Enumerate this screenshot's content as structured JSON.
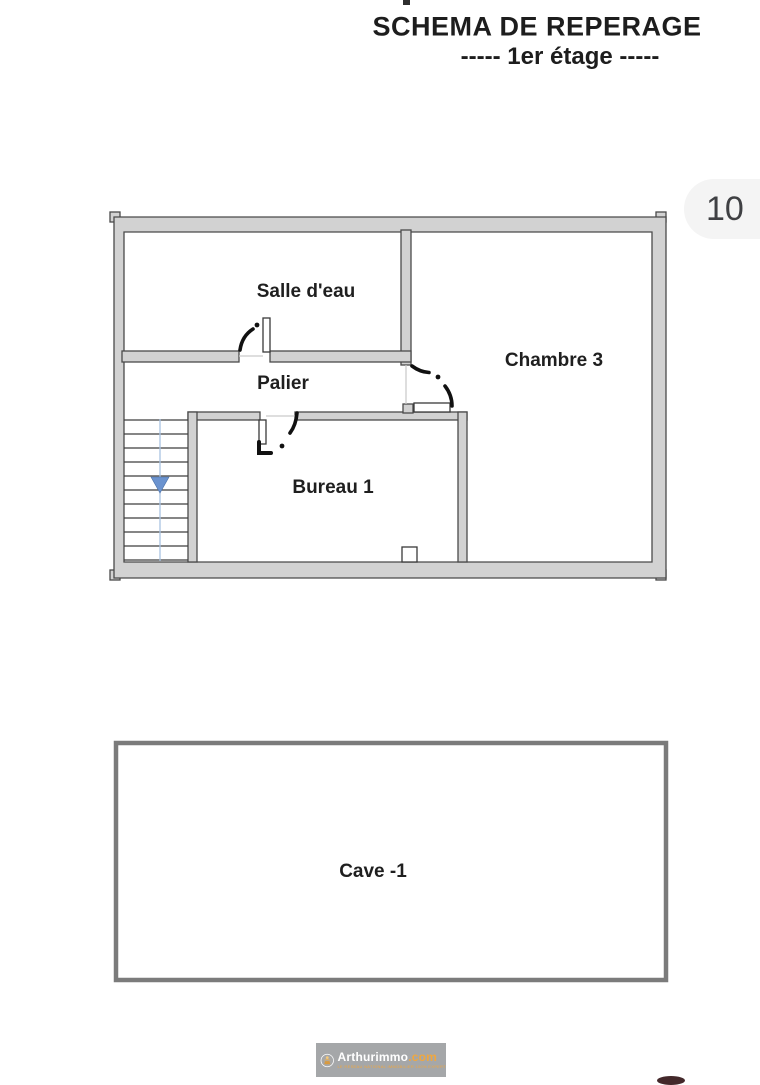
{
  "header": {
    "title": "SCHEMA DE REPERAGE",
    "subtitle": "-----  1er étage  -----",
    "page_badge": "10"
  },
  "floorplan": {
    "rooms": {
      "salle_deau": {
        "label": "Salle d'eau"
      },
      "palier": {
        "label": "Palier"
      },
      "bureau": {
        "label": "Bureau 1"
      },
      "chambre": {
        "label": "Chambre 3"
      }
    },
    "stairs": {
      "direction": "down"
    }
  },
  "basement": {
    "cave": {
      "label": "Cave -1"
    }
  },
  "footer": {
    "brand": "Arthurimmo",
    "brand_suffix": ".com",
    "tagline": "LE RESEAU NATIONAL IMMOBILIER 100% EXPERT"
  },
  "colors": {
    "wall_fill": "#d2d2d2",
    "wall_outline": "#4a4a4a",
    "door_glyph": "#111111",
    "opening_line": "#c9c9c9",
    "stair_tread": "#3f3f3f",
    "stair_guide_blue": "#a9c2e2",
    "stair_arrow_blue": "#6b93cf",
    "cave_border": "#7b7b7b",
    "badge_bg": "#f4f4f4",
    "badge_text": "#3f4043",
    "logo_box_gray": "#a5a7a9",
    "brand_amber": "#f0a73e"
  }
}
